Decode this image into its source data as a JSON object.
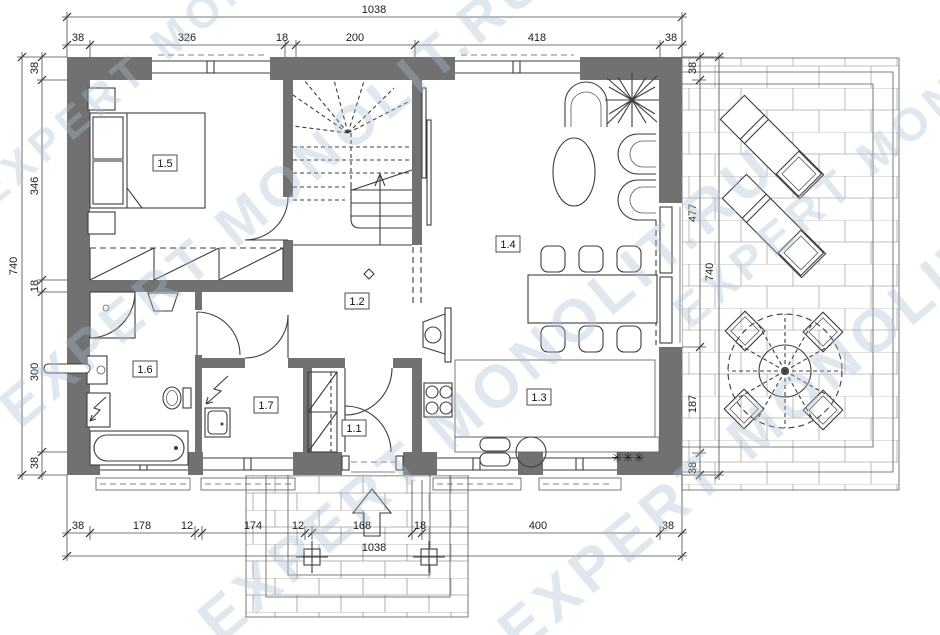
{
  "watermark": {
    "text": "EXPERT MONOLIT.RU",
    "color": "#a9bfd4"
  },
  "rooms": {
    "r11": "1.1",
    "r12": "1.2",
    "r13": "1.3",
    "r14": "1.4",
    "r15": "1.5",
    "r16": "1.6",
    "r17": "1.7"
  },
  "dims": {
    "top": {
      "total": "1038",
      "segments": [
        "38",
        "326",
        "18",
        "200",
        "418",
        "38"
      ]
    },
    "bottom": {
      "total": "1038",
      "segments": [
        "38",
        "178",
        "12",
        "174",
        "12",
        "168",
        "18",
        "400",
        "38"
      ]
    },
    "left": {
      "total": "740",
      "segments": [
        "38",
        "346",
        "18",
        "300",
        "38"
      ]
    },
    "right": {
      "total": "740",
      "segments": [
        "38",
        "477",
        "187",
        "38"
      ]
    }
  },
  "symbols": {
    "fridge": "✳✳✳"
  },
  "colors": {
    "wall": "#717171",
    "line": "#3d3d3d",
    "tile": "#a9a9a9",
    "watermark": "#a9bfd4",
    "background": "#ffffff"
  }
}
